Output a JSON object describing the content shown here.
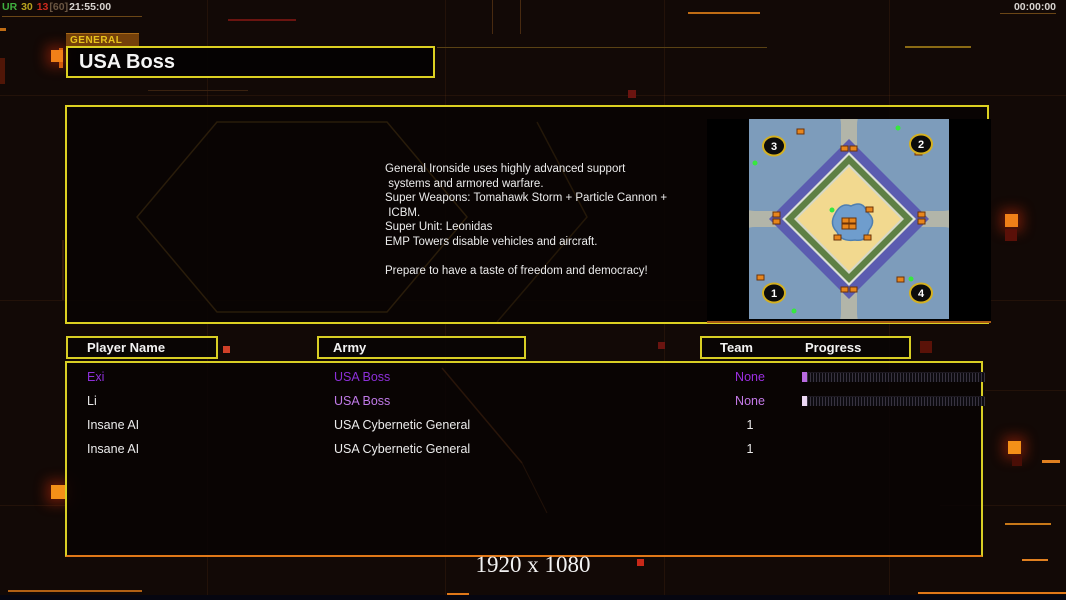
{
  "overlay": {
    "perf_label": "UR",
    "perf_fps": "30",
    "perf_ms": "13",
    "perf_cap": "[60]",
    "perf_time": "21:55:00",
    "clock": "00:00:00",
    "resolution_text": "1920 x 1080"
  },
  "general_panel": {
    "tab_label": "GENERAL",
    "title": "USA Boss",
    "description": "General Ironside uses highly advanced support\n systems and armored warfare.\nSuper Weapons: Tomahawk Storm + Particle Cannon +\n ICBM.\nSuper Unit: Leonidas\nEMP Towers disable vehicles and aircraft.\n\nPrepare to have a taste of freedom and democracy!"
  },
  "minimap": {
    "position_labels": [
      "1",
      "2",
      "3",
      "4"
    ]
  },
  "lobby_table": {
    "header_player": "Player Name",
    "header_army": "Army",
    "header_team": "Team",
    "header_progress": "Progress",
    "rows": [
      {
        "name": "Exi",
        "army": "USA Boss",
        "team": "None",
        "color": "#8c2fd8",
        "army_color": "#8c2fd8",
        "team_color": "#9b2fe0",
        "progress_cap": "#b86ae0"
      },
      {
        "name": "Li",
        "army": "USA Boss",
        "team": "None",
        "color": "#e6e6e6",
        "army_color": "#c07ae8",
        "team_color": "#c47ae8",
        "progress_cap": "#ecd8f4"
      },
      {
        "name": "Insane AI",
        "army": "USA Cybernetic General",
        "team": "1",
        "color": "#ececec",
        "army_color": "#ececec",
        "team_color": "#ececec"
      },
      {
        "name": "Insane AI",
        "army": "USA Cybernetic General",
        "team": "1",
        "color": "#ececec",
        "army_color": "#ececec",
        "team_color": "#ececec"
      }
    ]
  },
  "colors": {
    "accent_yellow": "#d8ce24",
    "accent_orange": "#e07818",
    "tab_gold": "#e8c31c",
    "player_purple": "#8c2fd8",
    "player_light_purple": "#c07ae8",
    "text_white": "#ececec"
  }
}
